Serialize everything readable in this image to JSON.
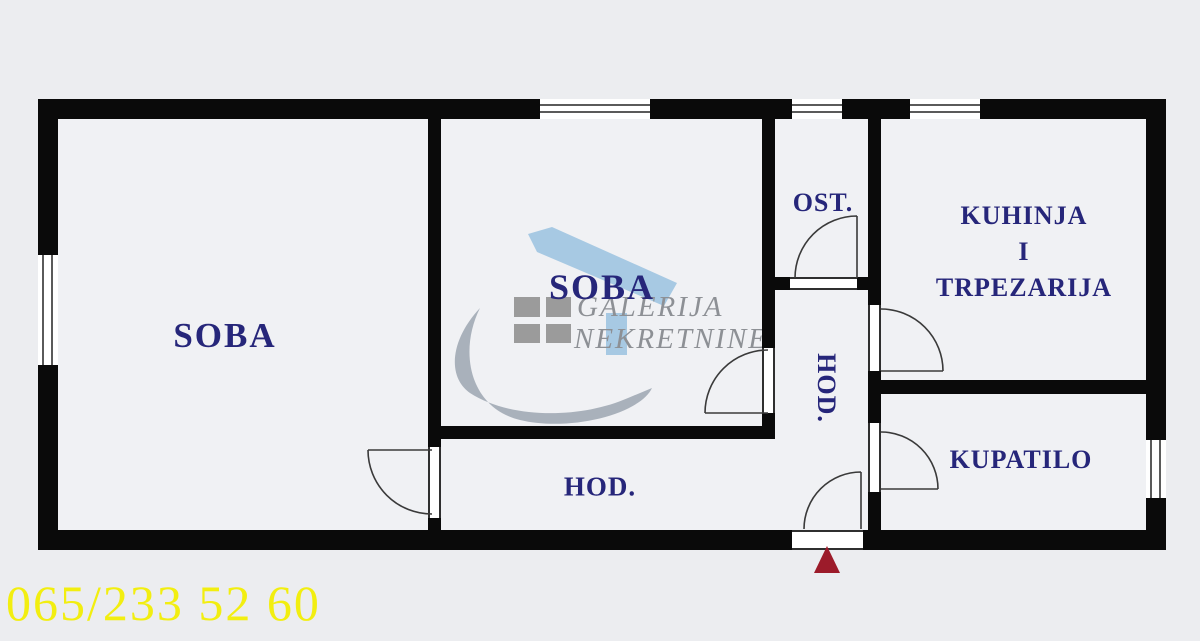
{
  "floor_plan": {
    "rooms": {
      "soba1": {
        "label": "SOBA"
      },
      "soba2": {
        "label": "SOBA"
      },
      "ost": {
        "label": "OST."
      },
      "kuhinja": {
        "line1": "KUHINJA",
        "line2": "I",
        "line3": "TRPEZARIJA"
      },
      "hod_vertical": {
        "label": "HOD."
      },
      "hod_lower": {
        "label": "HOD."
      },
      "kupatilo": {
        "label": "KUPATILO"
      }
    },
    "entrance_marker": "red-triangle-up"
  },
  "watermark": {
    "line1": "GALERIJA",
    "line2": "NEKRETNINE"
  },
  "contact": {
    "phone": "065/233 52 60"
  },
  "colors": {
    "background": "#ecedf0",
    "wall": "#0a0a0a",
    "room_label": "#26267a",
    "phone_yellow": "#f2ee10",
    "entrance_arrow_red": "#9c1b2a",
    "watermark_gray": "#8d9095",
    "watermark_blue": "#a7c9e3",
    "watermark_swoosh": "#a4adb7"
  }
}
